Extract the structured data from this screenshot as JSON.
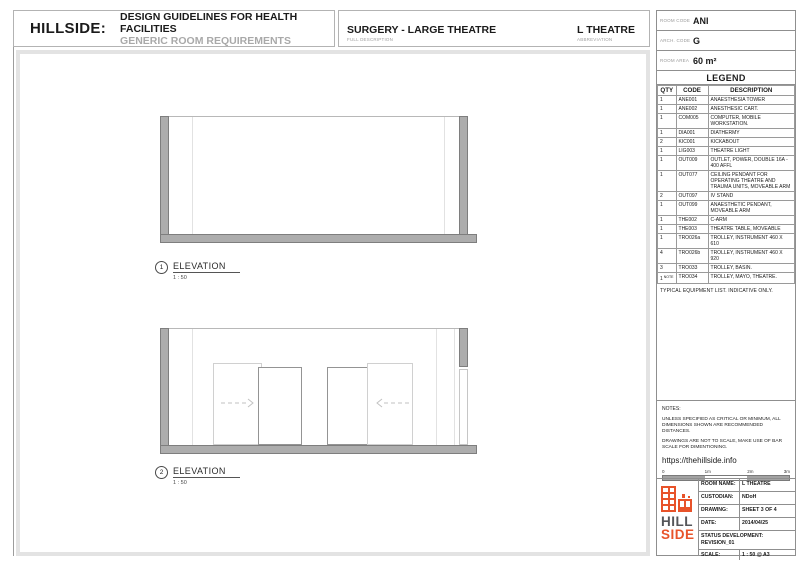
{
  "header": {
    "brand": "HILLSIDE:",
    "title": "DESIGN GUIDELINES FOR HEALTH FACILITIES",
    "subtitle": "GENERIC ROOM REQUIREMENTS",
    "room_title": "SURGERY - LARGE THEATRE",
    "room_title_label": "FULL DESCRIPTION",
    "abbreviation": "L THEATRE",
    "abbreviation_label": "ABBREVIATION"
  },
  "room_info": {
    "rows": [
      {
        "label": "ROOM CODE",
        "value": "ANI"
      },
      {
        "label": "ARCH. CODE",
        "value": "G"
      },
      {
        "label": "ROOM AREA",
        "value": "60 m²"
      }
    ]
  },
  "legend": {
    "title": "LEGEND",
    "columns": [
      "QTY",
      "CODE",
      "DESCRIPTION"
    ],
    "rows": [
      {
        "qty": "1",
        "code": "ANE001",
        "description": "ANAESTHESIA TOWER"
      },
      {
        "qty": "1",
        "code": "ANE002",
        "description": "ANESTHESIC CART."
      },
      {
        "qty": "1",
        "code": "COM005",
        "description": "COMPUTER, MOBILE WORKSTATION."
      },
      {
        "qty": "1",
        "code": "DIA001",
        "description": "DIATHERMY"
      },
      {
        "qty": "2",
        "code": "KIC001",
        "description": "KICKABOUT"
      },
      {
        "qty": "1",
        "code": "LIG003",
        "description": "THEATRE LIGHT"
      },
      {
        "qty": "1",
        "code": "OUT009",
        "description": "OUTLET, POWER, DOUBLE 16A - 400 AFFL"
      },
      {
        "qty": "1",
        "code": "OUT077",
        "description": "CEILING PENDANT FOR OPERATING THEATRE AND TRAUMA UNITS, MOVEABLE ARM"
      },
      {
        "qty": "2",
        "code": "OUT097",
        "description": "IV STAND"
      },
      {
        "qty": "1",
        "code": "OUT099",
        "description": "ANAESTHETIC PENDANT, MOVEABLE ARM"
      },
      {
        "qty": "1",
        "code": "THE002",
        "description": "C-ARM"
      },
      {
        "qty": "1",
        "code": "THE003",
        "description": "THEATRE TABLE, MOVEABLE"
      },
      {
        "qty": "1",
        "code": "TRO026a",
        "description": "TROLLEY, INSTRUMENT 460 X 610"
      },
      {
        "qty": "4",
        "code": "TRO026b",
        "description": "TROLLEY, INSTRUMENT 460 X 920"
      },
      {
        "qty": "3",
        "code": "TRO033",
        "description": "TROLLEY, BASIN."
      },
      {
        "qty": "1",
        "qty_note": "NOTE",
        "code": "TRO034",
        "description": "TROLLEY, MAYO, THEATRE."
      }
    ],
    "footnote": "TYPICAL EQUIPMENT LIST. INDICATIVE ONLY."
  },
  "notes": {
    "title": "NOTES:",
    "paragraphs": [
      "UNLESS SPECIFIED AS CRITICAL OR MINIMUM, ALL DIMENSIONS SHOWN ARE RECOMMENDED DISTANCES.",
      "DRAWINGS ARE NOT TO SCALE, MAKE USE OF BAR SCALE FOR DIMENTIONING."
    ],
    "url": "https://thehillside.info",
    "scale_bar": {
      "ticks": [
        "0",
        "1m",
        "2m",
        "3m"
      ]
    }
  },
  "drawings": [
    {
      "number": "1",
      "label": "ELEVATION",
      "scale": "1 : 50"
    },
    {
      "number": "2",
      "label": "ELEVATION",
      "scale": "1 : 50"
    }
  ],
  "title_block": {
    "logo_line1": "HILL",
    "logo_line2": "SIDE",
    "rows": [
      {
        "label": "ROOM NAME:",
        "value": "L THEATRE"
      },
      {
        "label": "CUSTODIAN:",
        "value": "NDoH"
      },
      {
        "label": "DRAWING:",
        "value": "SHEET 3 OF 4"
      },
      {
        "label": "DATE:",
        "value": "2014/04/25"
      }
    ],
    "status_label": "STATUS DEVELOPMENT:",
    "status_value": "REVISION_01",
    "scale_label": "SCALE:",
    "scale_value": "1 : 50 @ A3"
  },
  "colors": {
    "accent_orange": "#E8532A",
    "band_gray": "#ADADAD",
    "subtitle_gray": "#A9A9A9"
  }
}
